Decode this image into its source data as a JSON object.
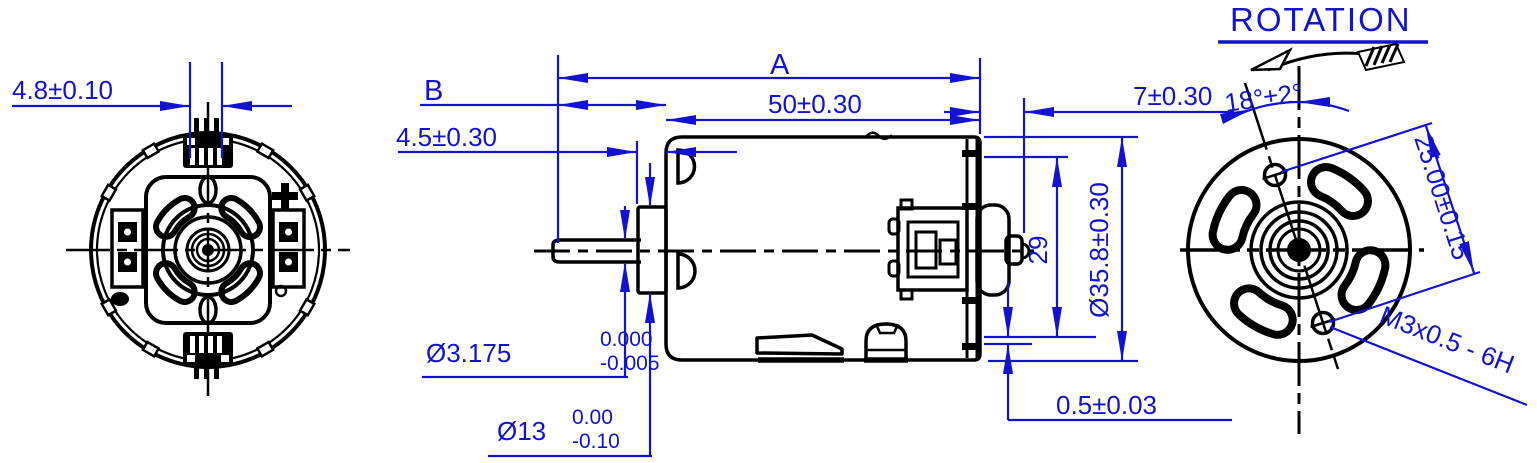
{
  "labels": {
    "rotation": "ROTATION",
    "dim_terminal_width": "4.8±0.10",
    "dim_overall_length": "A",
    "dim_shaft_extension": "B",
    "dim_body_length": "50±0.30",
    "dim_endbell_length": "7±0.30",
    "dim_bushing_length": "4.5±0.30",
    "dim_shaft_dia": "Ø3.175",
    "dim_shaft_dia_tol_upper": "0.000",
    "dim_shaft_dia_tol_lower": "-0.005",
    "dim_bushing_dia": "Ø13",
    "dim_bushing_dia_tol_upper": "0.00",
    "dim_bushing_dia_tol_lower": "-0.10",
    "dim_brushplate_dia": "29",
    "dim_body_dia": "Ø35.8±0.30",
    "dim_endcap_step": "0.5±0.03",
    "dim_hole_angle": "18°±2°",
    "dim_hole_spacing": "25.00±0.15",
    "dim_thread": "M3x0.5 - 6H"
  },
  "colors": {
    "dimension_blue": "#1212d0",
    "line_black": "#000000",
    "background": "#ffffff"
  }
}
